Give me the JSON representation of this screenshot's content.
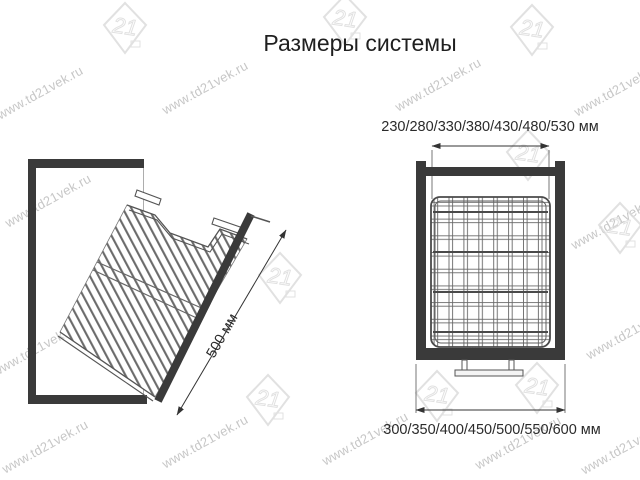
{
  "title": "Размеры системы",
  "left_diagram": {
    "description": "tilted pull-out wire basket side view",
    "dimension_label": "500 мм"
  },
  "right_diagram": {
    "description": "front view of wire basket inside cabinet",
    "top_dimension_label": "230/280/330/380/430/480/530 мм",
    "bottom_dimension_label": "300/350/400/450/500/550/600 мм"
  },
  "watermark": {
    "text": "www.td21vek.ru",
    "logo_text": "21",
    "text_color": "#c7c7c7",
    "logo_color": "#dcdcdc"
  },
  "colors": {
    "background": "#ffffff",
    "frame": "#3a3a3a",
    "wire": "#6a6a6a",
    "dimension_line": "#333333",
    "title_text": "#1f1f1f"
  }
}
